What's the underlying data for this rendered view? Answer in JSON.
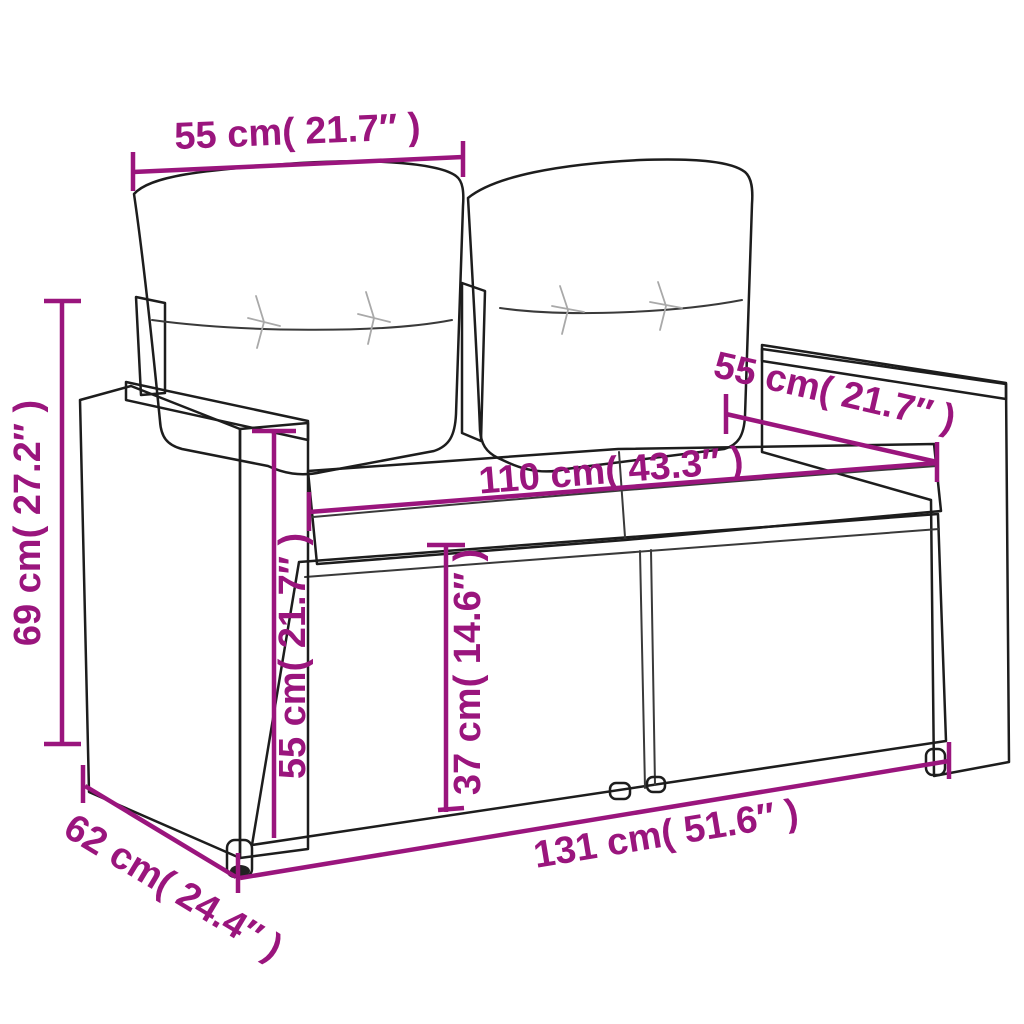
{
  "accent_color": "#9a157d",
  "illustration": {
    "name": "rattan-2-seater-garden-sofa-with-cushions"
  },
  "dimensions": {
    "back_cushion_width": {
      "cm": 55,
      "inches": 21.7,
      "label": "55 cm( 21.7″ )"
    },
    "overall_height": {
      "cm": 69,
      "inches": 27.2,
      "label": "69 cm( 27.2″ )"
    },
    "armrest_depth": {
      "cm": 55,
      "inches": 21.7,
      "label": "55 cm( 21.7″ )"
    },
    "seat_width": {
      "cm": 110,
      "inches": 43.3,
      "label": "110 cm( 43.3″ )"
    },
    "armrest_height": {
      "cm": 55,
      "inches": 21.7,
      "label": "55 cm( 21.7″ )"
    },
    "seat_height": {
      "cm": 37,
      "inches": 14.6,
      "label": "37 cm( 14.6″ )"
    },
    "overall_depth": {
      "cm": 62,
      "inches": 24.4,
      "label": "62 cm( 24.4″ )"
    },
    "overall_width": {
      "cm": 131,
      "inches": 51.6,
      "label": "131 cm( 51.6″ )"
    }
  }
}
